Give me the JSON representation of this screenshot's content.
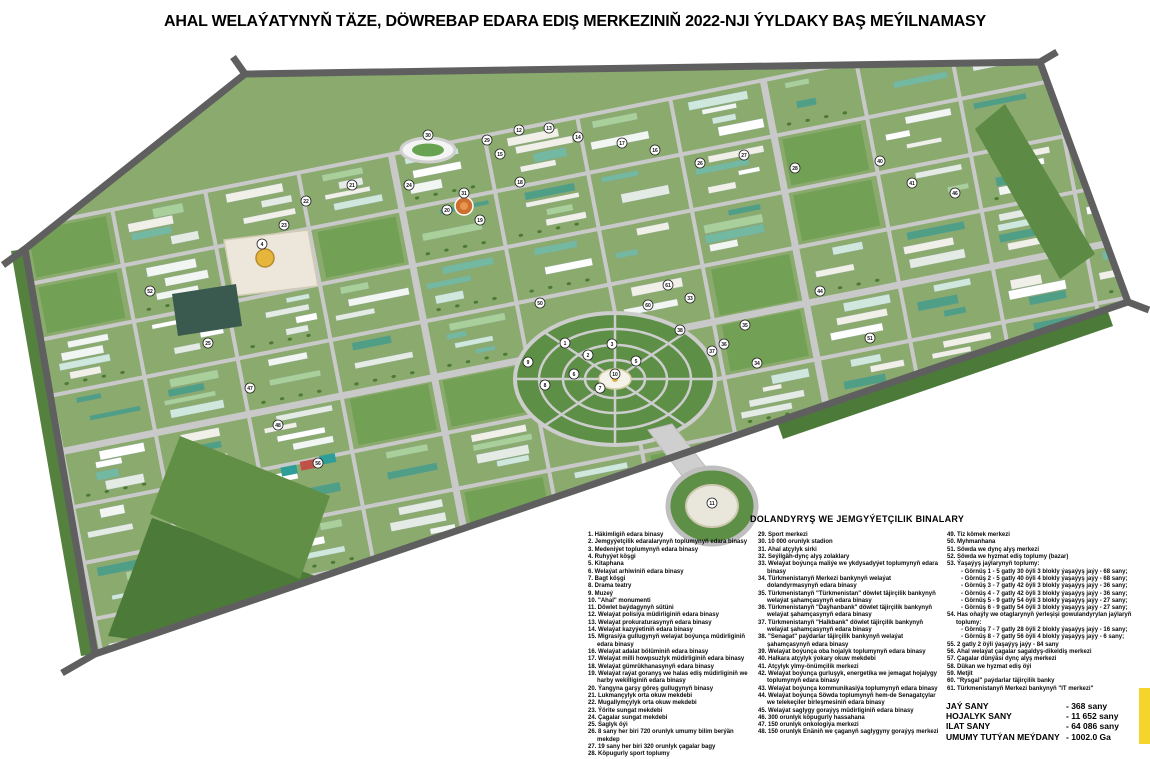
{
  "title": "AHAL WELAÝATYNYŇ TÄZE, DÖWREBAP EDARA EDIŞ MERKEZINIŇ 2022-NJI ÝYLDAKY BAŞ MEÝILNAMASY",
  "legend": {
    "header": "DOLANDYRYŞ WE JEMGYÝETÇILIK BINALARY",
    "col1": [
      "1. Häkimligiň edara binasy",
      "2. Jemgyýetçilik edaralarynyň toplumynyň edara binasy",
      "3. Medeniýet toplumynyň edara binasy",
      "4. Ruhyýet köşgi",
      "5. Kitaphana",
      "6. Welaýat arhiwiniň edara binasy",
      "7. Bagt köşgi",
      "8. Drama teatry",
      "9. Muzeý",
      "10. \"Ahal\" monumenti",
      "11. Döwlet baýdagynyň sütüni",
      "12. Welaýat polisiýa müdirliginiň edara binasy",
      "13. Welaýat prokuraturasynyň edara binasy",
      "14. Welaýat kazyýetiniň edara binasy",
      "15. Migrasiýa gullugynyň welaýat boýunça müdirliginiň edara binasy",
      "16. Welaýat adalat bölüminiň edara binasy",
      "17. Welaýat milli howpsuzlyk müdirliginiň edara binasy",
      "18. Welaýat gümrükhanasynyň edara binasy",
      "19. Welaýat raýat goranyş we halas ediş müdirliginiň we harby wekilliginiň edara binasy",
      "20. Ýangyna garşy göreş gullugynyň binasy",
      "21. Lukmançylyk orta okuw mekdebi",
      "22. Mugallymçylyk orta okuw mekdebi",
      "23. Ýörite sungat mekdebi",
      "24. Çagalar sungat mekdebi",
      "25. Saglyk öýi",
      "26. 8 sany her biri 720 orunlyk umumy bilim berýän mekdep",
      "27. 19 sany her biri 320 orunlyk çagalar bagy",
      "28. Köpugurly sport toplumy"
    ],
    "col2": [
      "29. Sport merkezi",
      "30. 10 000 orunlyk stadion",
      "31. Ahal atçylyk sirki",
      "32. Seýilgäh-dynç alyş zolaklary",
      "33. Welaýat boýunça maliýe we ykdysadyýet toplumynyň edara binasy",
      "34. Türkmenistanyň Merkezi bankynyň welaýat dolandyrmasynyň edara binasy",
      "35. Türkmenistanyň \"Türkmenistan\" döwlet täjirçilik bankynyň welaýat şahamçasynyň edara binasy",
      "36. Türkmenistanyň \"Daýhanbank\" döwlet täjirçilik bankynyň welaýat şahamçasynyň edara binasy",
      "37. Türkmenistanyň \"Halkbank\" döwlet täjirçilik bankynyň welaýat şahamçasynyň edara binasy",
      "38. \"Senagat\" paýdarlar täjirçilik bankynyň welaýat şahamçasynyň edara binasy",
      "39. Welaýat boýunça oba hojalyk toplumynyň edara binasy",
      "40. Halkara atçylyk ýokary okuw mekdebi",
      "41. Atçylyk ylmy-önümçilik merkezi",
      "42. Welaýat boýunça gurluşyk, energetika we jemagat hojalygy toplumynyň edara binasy",
      "43. Welaýat boýunça kommunikasiýa toplumynyň edara binasy",
      "44. Welaýat boýunça Söwda toplumynyň hem-de Senagatçylar we telekeçiler birleşmesiniň edara binasy",
      "45. Welaýat saglygy goraýyş müdirliginiň edara binasy",
      "46. 300 orunlyk köpugurly hassahana",
      "47. 150 orunlyk onkologiýa merkezi",
      "48. 150 orunlyk Enäniň we çaganyň saglygyny goraýyş merkezi"
    ],
    "col3": [
      "49. Tiz kömek merkezi",
      "50. Myhmanhana",
      "51. Söwda we dynç alyş merkezi",
      "52. Söwda we hyzmat ediş toplumy (bazar)",
      "53. Ýaşaýyş jaýlarynyň toplumy:",
      "- Görnüş 1 - 5 gatly 30 öýli 3 blokly ýaşaýyş jaýy - 68 sany;",
      "- Görnüş 2 - 5 gatly 40 öýli 4 blokly ýaşaýyş jaýy - 68 sany;",
      "- Görnüş 3 - 7 gatly 42 öýli 3 blokly ýaşaýyş jaýy - 36 sany;",
      "- Görnüş 4 - 7 gatly 42 öýli 3 blokly ýaşaýyş jaýy - 36 sany;",
      "- Görnüş 5 - 9 gatly 54 öýli 3 blokly ýaşaýyş jaýy - 27 sany;",
      "- Görnüş 6 - 9 gatly 54 öýli 3 blokly ýaşaýyş jaýy - 27 sany;",
      "54. Has oňaýly we otaglarynyň ýerleşişi gowulandyrylan jaýlaryň toplumy:",
      "- Görnüş 7 - 7 gatly 28 öýli 2 blokly ýaşaýyş jaýy - 16 sany;",
      "- Görnüş 8 - 7 gatly 56 öýli 4 blokly ýaşaýyş jaýy - 6 sany;",
      "55. 2 gatly 2 öýli ýaşaýyş jaýy - 84 sany",
      "56. Ahal welaýat çagalar sagaldyş-dikeldiş merkezi",
      "57. Çagalar dünýäsi dynç alyş merkezi",
      "58. Dükan we hyzmat ediş öýi",
      "59. Metjit",
      "60. \"Rysgal\" paýdarlar täjirçilik banky",
      "61. Türkmenistanyň Merkezi bankynyň \"IT merkezi\""
    ]
  },
  "stats": {
    "rows": [
      {
        "label": "JAÝ SANY",
        "value": "- 368 sany"
      },
      {
        "label": "HOJALYK SANY",
        "value": "- 11 652 sany"
      },
      {
        "label": "ILAT SANY",
        "value": "- 64 086 sany"
      },
      {
        "label": "UMUMY TUTÝAN MEÝDANY",
        "value": "- 1002.0 Ga"
      }
    ]
  },
  "colors": {
    "accent_yellow": "#f6d32d",
    "base_green": "#8aab6d",
    "field_green": "#4c7a39",
    "park_green": "#6f9e52",
    "road_gray": "#c9c9c9",
    "boundary_gray": "#5f5f5f",
    "dome_gold": "#e5b63b"
  },
  "map": {
    "palette": [
      "#ffffff",
      "#f1f6f2",
      "#cfe8de",
      "#73b9a2",
      "#4f9f86",
      "#e4ebe4",
      "#a9cf9a",
      "#f0efe8"
    ],
    "markers": [
      {
        "n": "1",
        "x": 565,
        "y": 299
      },
      {
        "n": "2",
        "x": 588,
        "y": 311
      },
      {
        "n": "3",
        "x": 612,
        "y": 300
      },
      {
        "n": "4",
        "x": 262,
        "y": 200
      },
      {
        "n": "5",
        "x": 636,
        "y": 317
      },
      {
        "n": "6",
        "x": 574,
        "y": 330
      },
      {
        "n": "7",
        "x": 600,
        "y": 344
      },
      {
        "n": "8",
        "x": 545,
        "y": 341
      },
      {
        "n": "9",
        "x": 528,
        "y": 318
      },
      {
        "n": "10",
        "x": 615,
        "y": 330
      },
      {
        "n": "11",
        "x": 712,
        "y": 459
      },
      {
        "n": "12",
        "x": 519,
        "y": 86
      },
      {
        "n": "13",
        "x": 549,
        "y": 84
      },
      {
        "n": "14",
        "x": 578,
        "y": 93
      },
      {
        "n": "15",
        "x": 500,
        "y": 110
      },
      {
        "n": "16",
        "x": 655,
        "y": 106
      },
      {
        "n": "17",
        "x": 622,
        "y": 99
      },
      {
        "n": "18",
        "x": 520,
        "y": 138
      },
      {
        "n": "19",
        "x": 480,
        "y": 176
      },
      {
        "n": "20",
        "x": 447,
        "y": 166
      },
      {
        "n": "21",
        "x": 352,
        "y": 141
      },
      {
        "n": "22",
        "x": 306,
        "y": 157
      },
      {
        "n": "23",
        "x": 284,
        "y": 181
      },
      {
        "n": "24",
        "x": 409,
        "y": 141
      },
      {
        "n": "25",
        "x": 208,
        "y": 299
      },
      {
        "n": "26",
        "x": 700,
        "y": 119
      },
      {
        "n": "27",
        "x": 744,
        "y": 111
      },
      {
        "n": "28",
        "x": 795,
        "y": 124
      },
      {
        "n": "29",
        "x": 487,
        "y": 96
      },
      {
        "n": "30",
        "x": 428,
        "y": 91
      },
      {
        "n": "31",
        "x": 464,
        "y": 149
      },
      {
        "n": "33",
        "x": 690,
        "y": 254
      },
      {
        "n": "34",
        "x": 757,
        "y": 319
      },
      {
        "n": "35",
        "x": 745,
        "y": 281
      },
      {
        "n": "36",
        "x": 724,
        "y": 300
      },
      {
        "n": "37",
        "x": 712,
        "y": 307
      },
      {
        "n": "38",
        "x": 680,
        "y": 286
      },
      {
        "n": "40",
        "x": 880,
        "y": 117
      },
      {
        "n": "41",
        "x": 912,
        "y": 139
      },
      {
        "n": "44",
        "x": 820,
        "y": 247
      },
      {
        "n": "46",
        "x": 955,
        "y": 149
      },
      {
        "n": "47",
        "x": 250,
        "y": 344
      },
      {
        "n": "48",
        "x": 278,
        "y": 381
      },
      {
        "n": "50",
        "x": 540,
        "y": 259
      },
      {
        "n": "51",
        "x": 870,
        "y": 294
      },
      {
        "n": "52",
        "x": 150,
        "y": 247
      },
      {
        "n": "56",
        "x": 318,
        "y": 419
      },
      {
        "n": "60",
        "x": 648,
        "y": 261
      },
      {
        "n": "61",
        "x": 668,
        "y": 241
      }
    ]
  }
}
